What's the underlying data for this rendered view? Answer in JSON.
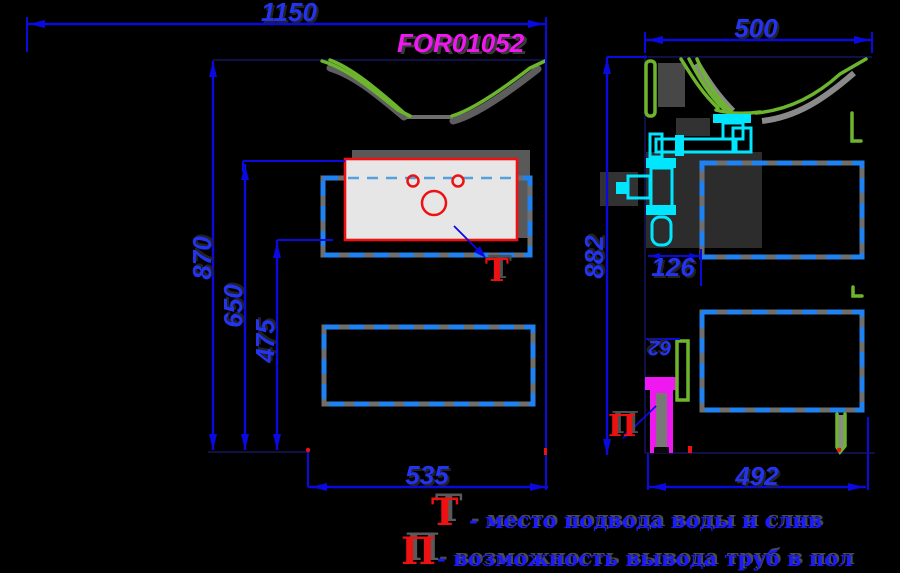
{
  "product_code": "FOR01052",
  "views": {
    "front": {
      "dims": {
        "total_width": "1150",
        "total_height": "870",
        "sink_top_height": "650",
        "cabinet_top_height": "475",
        "cabinet_width": "535"
      },
      "marker": "Т"
    },
    "side": {
      "dims": {
        "depth": "500",
        "height": "882",
        "siphon_offset": "126",
        "pipe_offset": "62",
        "cabinet_depth": "492"
      },
      "marker": "П"
    }
  },
  "legend": [
    {
      "symbol": "Т",
      "text": "- место подвода воды и слив"
    },
    {
      "symbol": "П",
      "text": "- возможность вывода труб в пол"
    }
  ],
  "colors": {
    "bg": "#000000",
    "dim_line": "#0a0ae0",
    "dim_text": "#2433f0",
    "legend_blue": "#1a1aff",
    "dash_blue": "#1f82f0",
    "waterline": "#55a0dd",
    "green": "#6cb52c",
    "cyan": "#00e6ff",
    "magenta": "#f018f0",
    "red": "#ee1111",
    "halo_gray": "#6e6e6e",
    "sink_fill": "#e6e6e6",
    "hidden_line": "#101048"
  }
}
